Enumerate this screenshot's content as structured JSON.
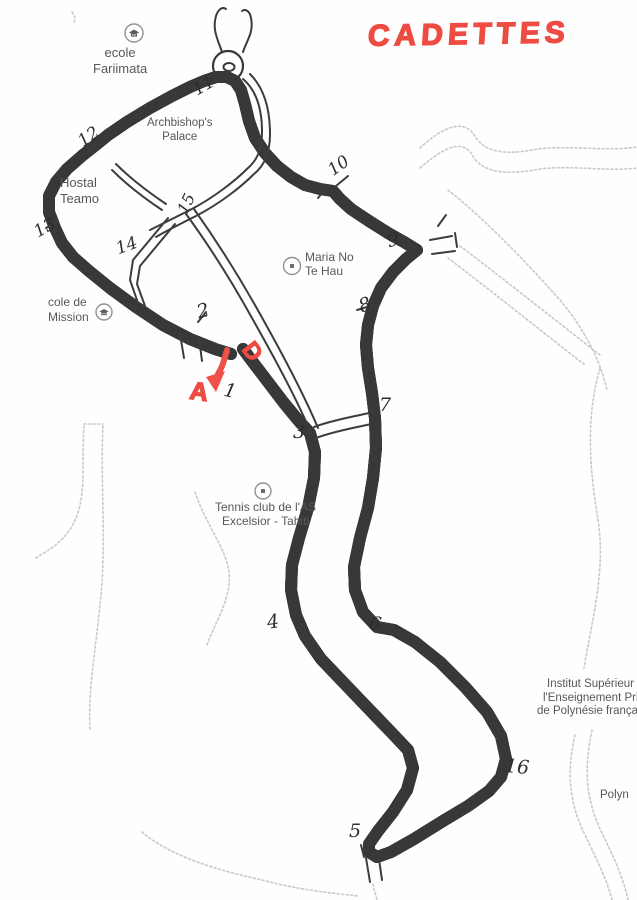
{
  "title": {
    "text": "CADETTES",
    "color": "#ee4b42"
  },
  "course": {
    "route_color": "#f4776d",
    "start_label": "D",
    "finish_label": "A"
  },
  "checkpoints": [
    {
      "label": "1"
    },
    {
      "label": "2"
    },
    {
      "label": "3"
    },
    {
      "label": "4"
    },
    {
      "label": "5"
    },
    {
      "label": "6"
    },
    {
      "label": "7"
    },
    {
      "label": "8"
    },
    {
      "label": "9"
    },
    {
      "label": "10"
    },
    {
      "label": "11"
    },
    {
      "label": "12"
    },
    {
      "label": "13"
    },
    {
      "label": "14"
    },
    {
      "label": "15"
    },
    {
      "label": "16"
    }
  ],
  "map_labels": {
    "ecole_fariimata": {
      "line1": "ecole",
      "line2": "Fariimata"
    },
    "archbishops_palace": {
      "line1": "Archbishop's",
      "line2": "Palace"
    },
    "hostal_teamo": {
      "line1": "Hostal",
      "line2": "Teamo"
    },
    "maria_no_te_hau": {
      "line1": "Maria No",
      "line2": "Te Hau"
    },
    "ecole_mission": {
      "line1": "cole de",
      "line2": "Mission"
    },
    "tennis_club": {
      "line1": "Tennis club de l'AS",
      "line2": "Excelsior - Tahiti"
    },
    "institut": {
      "line1": "Institut Supérieur",
      "line2": "l'Enseignement Privé",
      "line3": "de Polynésie française"
    },
    "polynesie": {
      "line1": "Polyn"
    }
  }
}
